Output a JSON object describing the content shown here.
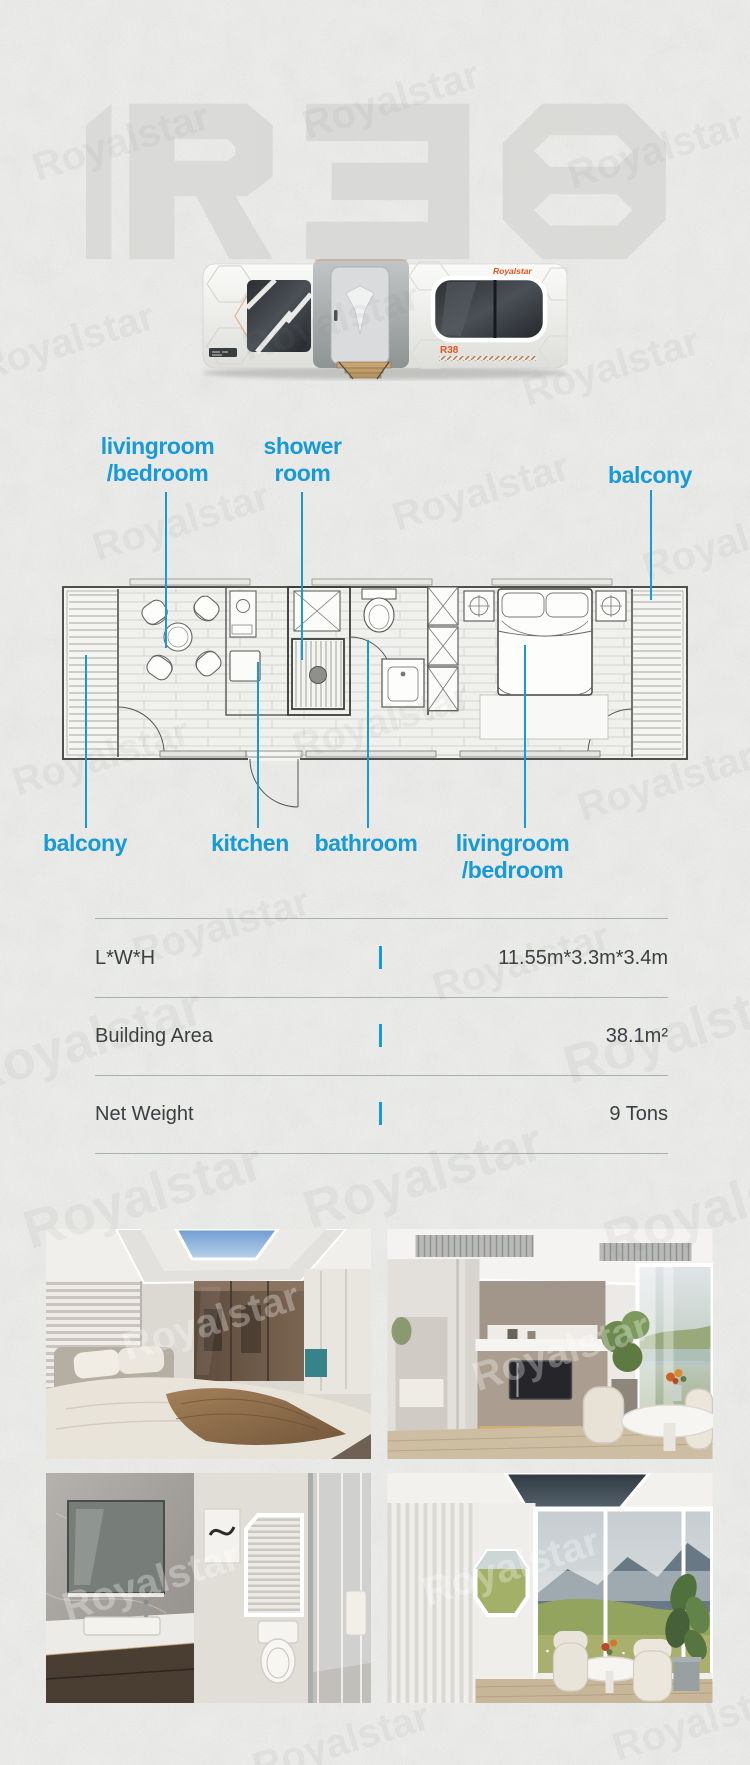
{
  "page": {
    "brand": "Royalstar",
    "model": "R38",
    "accent_color": "#189ad6",
    "brand_orange": "#e8541e",
    "paper_color": "#edeeeb"
  },
  "hero": {
    "ghost_logo": "R38",
    "house_brand_logo": "Royalstar",
    "house_model_label": "R38"
  },
  "floor_plan": {
    "top_labels": [
      {
        "id": "livingroom-bedroom-top",
        "line1": "livingroom",
        "line2": "/bedroom"
      },
      {
        "id": "shower-room",
        "line1": "shower",
        "line2": "room"
      },
      {
        "id": "balcony-right",
        "line1": "balcony"
      }
    ],
    "bottom_labels": [
      {
        "id": "balcony-left",
        "line1": "balcony"
      },
      {
        "id": "kitchen",
        "line1": "kitchen"
      },
      {
        "id": "bathroom",
        "line1": "bathroom"
      },
      {
        "id": "livingroom-bedroom-bottom",
        "line1": "livingroom",
        "line2": "/bedroom"
      }
    ]
  },
  "specs": {
    "rows": [
      {
        "label": "L*W*H",
        "value": "11.55m*3.3m*3.4m"
      },
      {
        "label": "Building Area",
        "value": "38.1m²"
      },
      {
        "label": "Net Weight",
        "value": "9 Tons"
      }
    ]
  },
  "gallery": {
    "photos": [
      {
        "name": "bedroom-interior"
      },
      {
        "name": "kitchen-dining-interior"
      },
      {
        "name": "bathroom-interior"
      },
      {
        "name": "panoramic-dining-interior"
      }
    ]
  }
}
